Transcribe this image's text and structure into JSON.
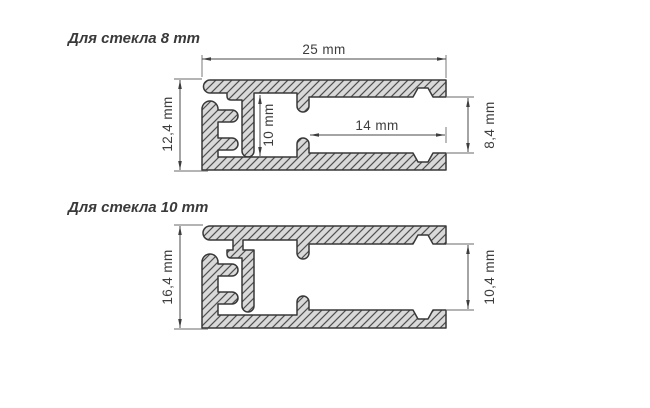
{
  "diagram": {
    "type": "technical-drawing",
    "units": "mm",
    "colors": {
      "outline": "#383838",
      "fill": "#d9d9d9",
      "hatch": "#4f4f4f",
      "dimension": "#3d3d3d"
    },
    "profiles": [
      {
        "title": "Для стекла 8 mm",
        "glass_thickness_mm": 8,
        "dims": {
          "width": "25 mm",
          "height": "12,4 mm",
          "inner_height": "10 mm",
          "inner_depth": "14 mm",
          "opening": "8,4 mm"
        }
      },
      {
        "title": "Для стекла 10 mm",
        "glass_thickness_mm": 10,
        "dims": {
          "height": "16,4 mm",
          "opening": "10,4 mm"
        }
      }
    ]
  }
}
